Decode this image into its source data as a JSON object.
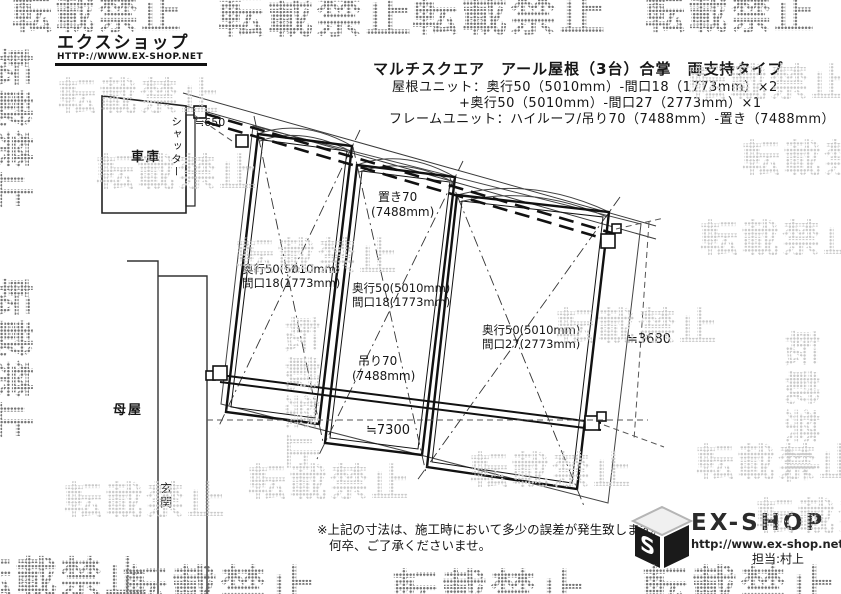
{
  "logo": {
    "name": "エクスショップ",
    "url": "HTTP://WWW.EX-SHOP.NET"
  },
  "title": {
    "line1": "マルチスクエア　アール屋根（3台）合掌　両支持タイプ",
    "line2": "屋根ユニット：奥行50（5010mm）-間口18（1773mm）×2",
    "line3": "+奥行50（5010mm）-間口27（2773mm）×1",
    "line4": "フレームユニット：ハイルーフ/吊り70（7488mm）-置き（7488mm）"
  },
  "drawing": {
    "garage": "車庫",
    "shutter": "シャッター",
    "house": "母屋",
    "entrance": "玄関",
    "dim650": "≒650",
    "dim7300": "≒7300",
    "dim3680": "≒3680",
    "beam_top": {
      "name": "置き70",
      "size": "(7488mm)"
    },
    "beam_bottom": {
      "name": "吊り70",
      "size": "(7488mm)"
    },
    "panel1": {
      "depth": "奥行50(5010mm)",
      "width": "間口18(1773mm)"
    },
    "panel2": {
      "depth": "奥行50(5010mm)",
      "width": "間口18(1773mm)"
    },
    "panel3": {
      "depth": "奥行50(5010mm)",
      "width": "間口27(2773mm)"
    }
  },
  "note": {
    "line1": "※上記の寸法は、施工時において多少の誤差が発生致します。",
    "line2": "何卒、ご了承くださいませ。"
  },
  "footer": {
    "brand": "EX-SHOP",
    "url": "http://www.ex-shop.net",
    "contact": "担当:村上"
  },
  "watermark": {
    "text": "転載禁止"
  }
}
